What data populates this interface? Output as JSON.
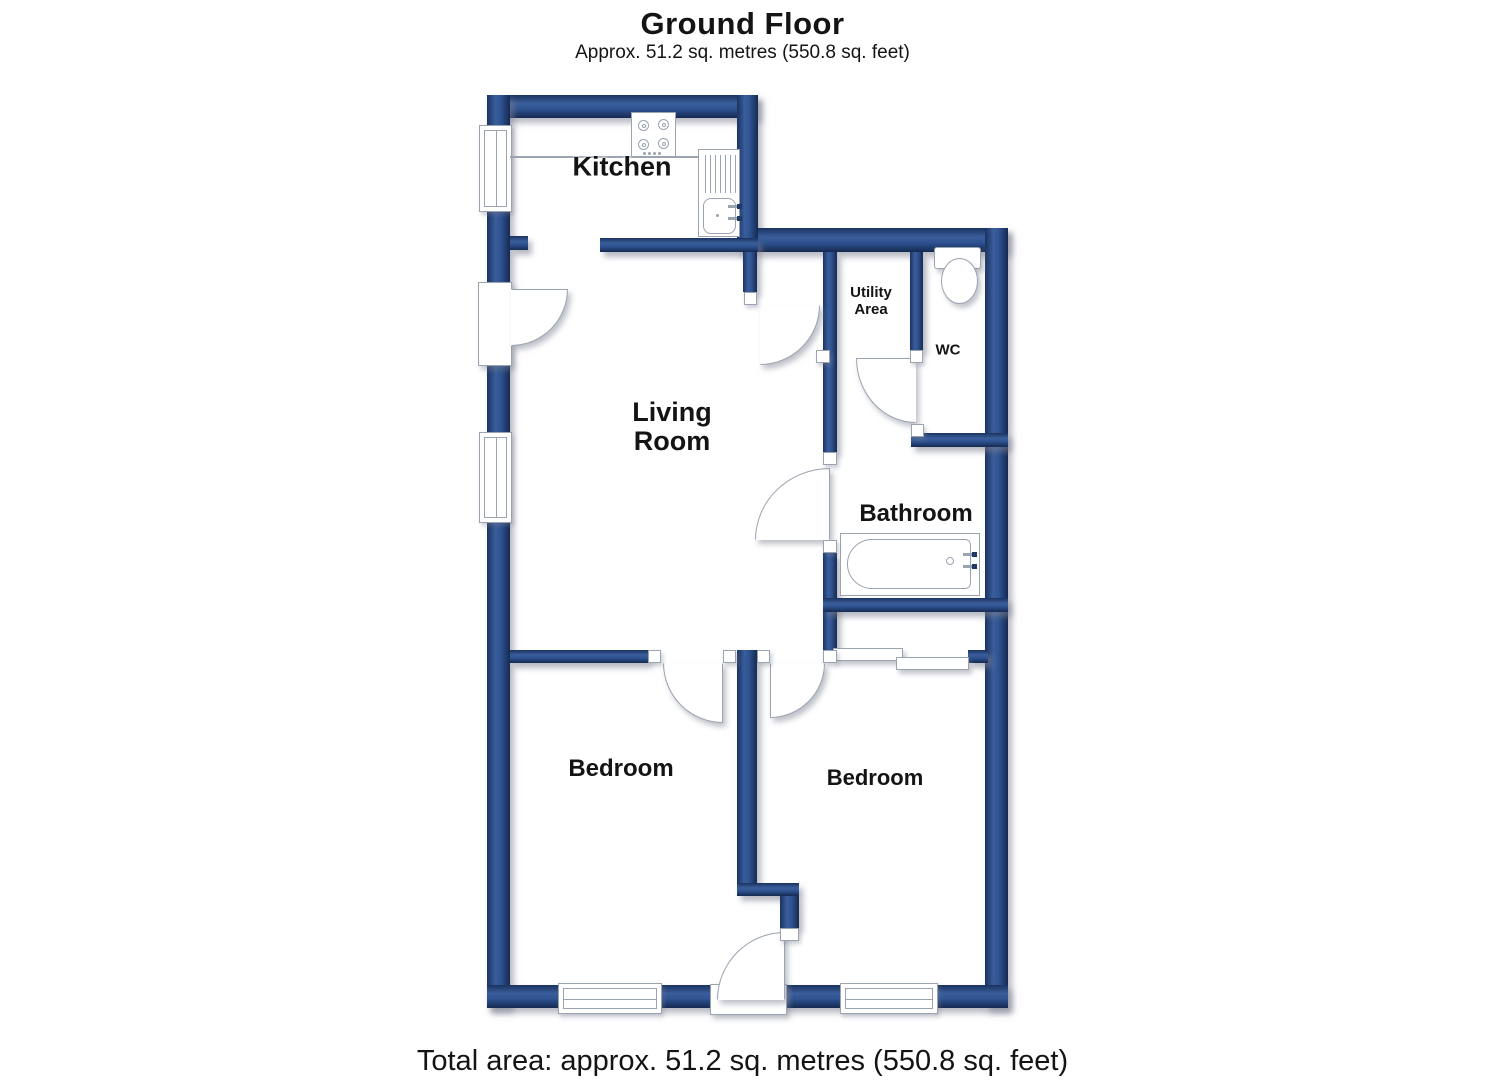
{
  "header": {
    "title": "Ground Floor",
    "subtitle": "Approx. 51.2 sq. metres (550.8 sq. feet)"
  },
  "rooms": {
    "kitchen": {
      "label": "Kitchen"
    },
    "living_room": {
      "label": "Living\nRoom"
    },
    "utility_area": {
      "label": "Utility\nArea"
    },
    "wc": {
      "label": "WC"
    },
    "bathroom": {
      "label": "Bathroom"
    },
    "bedroom_left": {
      "label": "Bedroom"
    },
    "bedroom_right": {
      "label": "Bedroom"
    }
  },
  "footer": {
    "total_area": "Total area: approx. 51.2 sq. metres (550.8 sq. feet)"
  },
  "colors": {
    "wall_mid": "#2e5190",
    "wall_edge": "#1b3360",
    "wall_light": "#3a5e9c",
    "outline": "#9aa3b0",
    "label": "#141414",
    "shadow": "rgba(125,130,145,0.55)"
  }
}
